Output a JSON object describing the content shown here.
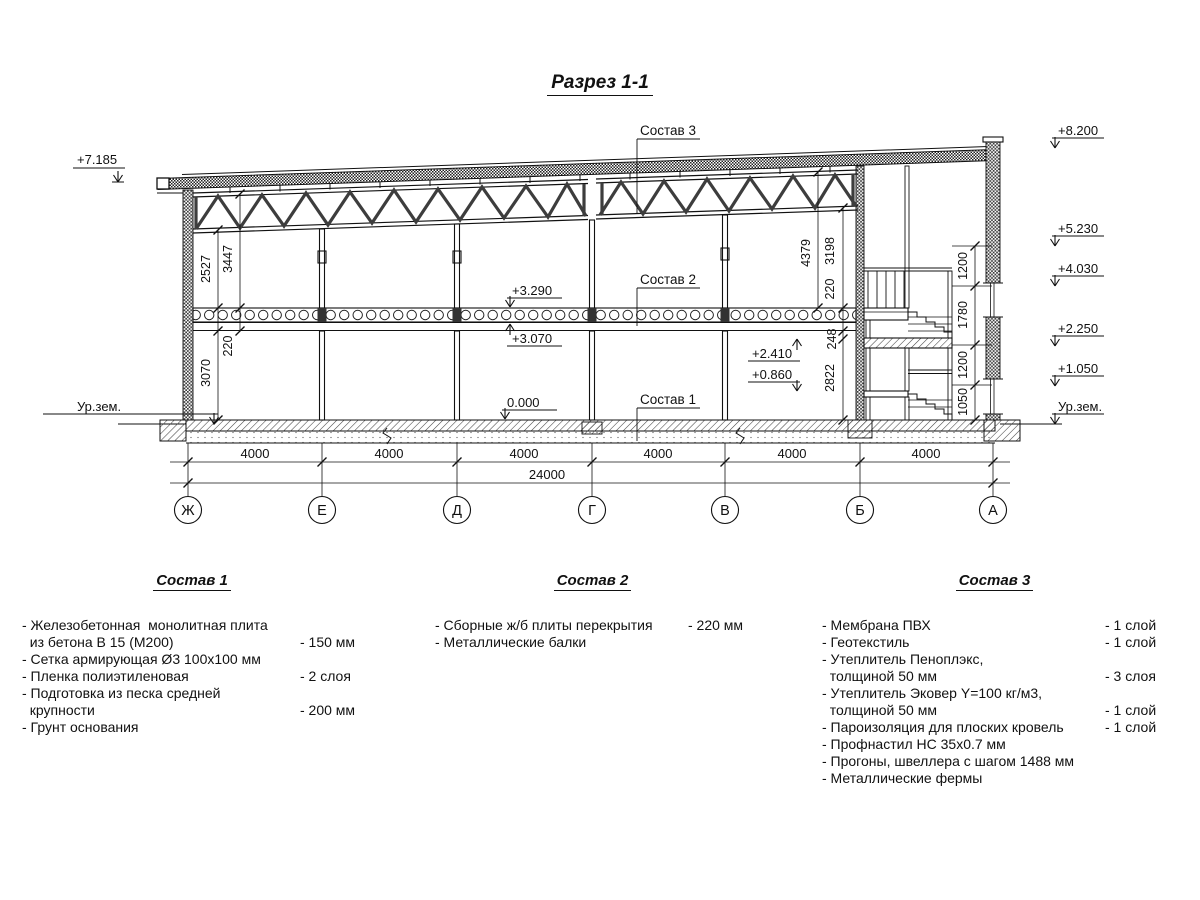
{
  "title": "Разрез 1-1",
  "drawing": {
    "callout_c1": "Состав 1",
    "callout_c2": "Состав 2",
    "callout_c3": "Состав 3",
    "elev_left_top": "+7.185",
    "elev_left_ground": "Ур.зем.",
    "elev_right": [
      "+8.200",
      "+5.230",
      "+4.030",
      "+2.250",
      "+1.050",
      "Ур.зем."
    ],
    "level_slab_top": "+3.290",
    "level_slab_bot": "+3.070",
    "level_floor": "0.000",
    "level_landing_mid": "+2.410",
    "level_landing_low": "+0.860",
    "dim_left": [
      "2527",
      "3447",
      "220",
      "3070"
    ],
    "dim_right": [
      "4379",
      "3198",
      "220",
      "248",
      "2822"
    ],
    "dim_stair": [
      "1200",
      "1780",
      "1200",
      "1050"
    ],
    "dim_bays": [
      "4000",
      "4000",
      "4000",
      "4000",
      "4000",
      "4000"
    ],
    "dim_total": "24000",
    "axes": [
      "Ж",
      "Е",
      "Д",
      "Г",
      "В",
      "Б",
      "А"
    ]
  },
  "legends": [
    {
      "title": "Состав 1",
      "items": [
        {
          "text": "- Железобетонная  монолитная плита\n  из бетона В 15 (М200)",
          "value": "- 150 мм"
        },
        {
          "text": "- Сетка армирующая Ø3 100х100 мм",
          "value": ""
        },
        {
          "text": "- Пленка полиэтиленовая",
          "value": "-  2 слоя"
        },
        {
          "text": "- Подготовка из песка средней\n  крупности",
          "value": "- 200 мм"
        },
        {
          "text": "- Грунт основания",
          "value": ""
        }
      ]
    },
    {
      "title": "Состав 2",
      "items": [
        {
          "text": "- Сборные ж/б плиты перекрытия",
          "value": "- 220 мм"
        },
        {
          "text": "- Металлические балки",
          "value": ""
        }
      ]
    },
    {
      "title": "Состав 3",
      "items": [
        {
          "text": "- Мембрана ПВХ",
          "value": "- 1 слой"
        },
        {
          "text": "- Геотекстиль",
          "value": "- 1 слой"
        },
        {
          "text": "- Утеплитель Пеноплэкс,\n  толщиной 50 мм",
          "value": "- 3 слоя"
        },
        {
          "text": "- Утеплитель Эковер Y=100 кг/м3,\n  толщиной 50 мм",
          "value": "- 1 слой"
        },
        {
          "text": "- Пароизоляция для плоских кровель",
          "value": "- 1 слой"
        },
        {
          "text": "- Профнастил НС 35х0.7 мм",
          "value": ""
        },
        {
          "text": "- Прогоны, швеллера с шагом 1488 мм",
          "value": ""
        },
        {
          "text": "- Металлические фермы",
          "value": ""
        }
      ]
    }
  ]
}
